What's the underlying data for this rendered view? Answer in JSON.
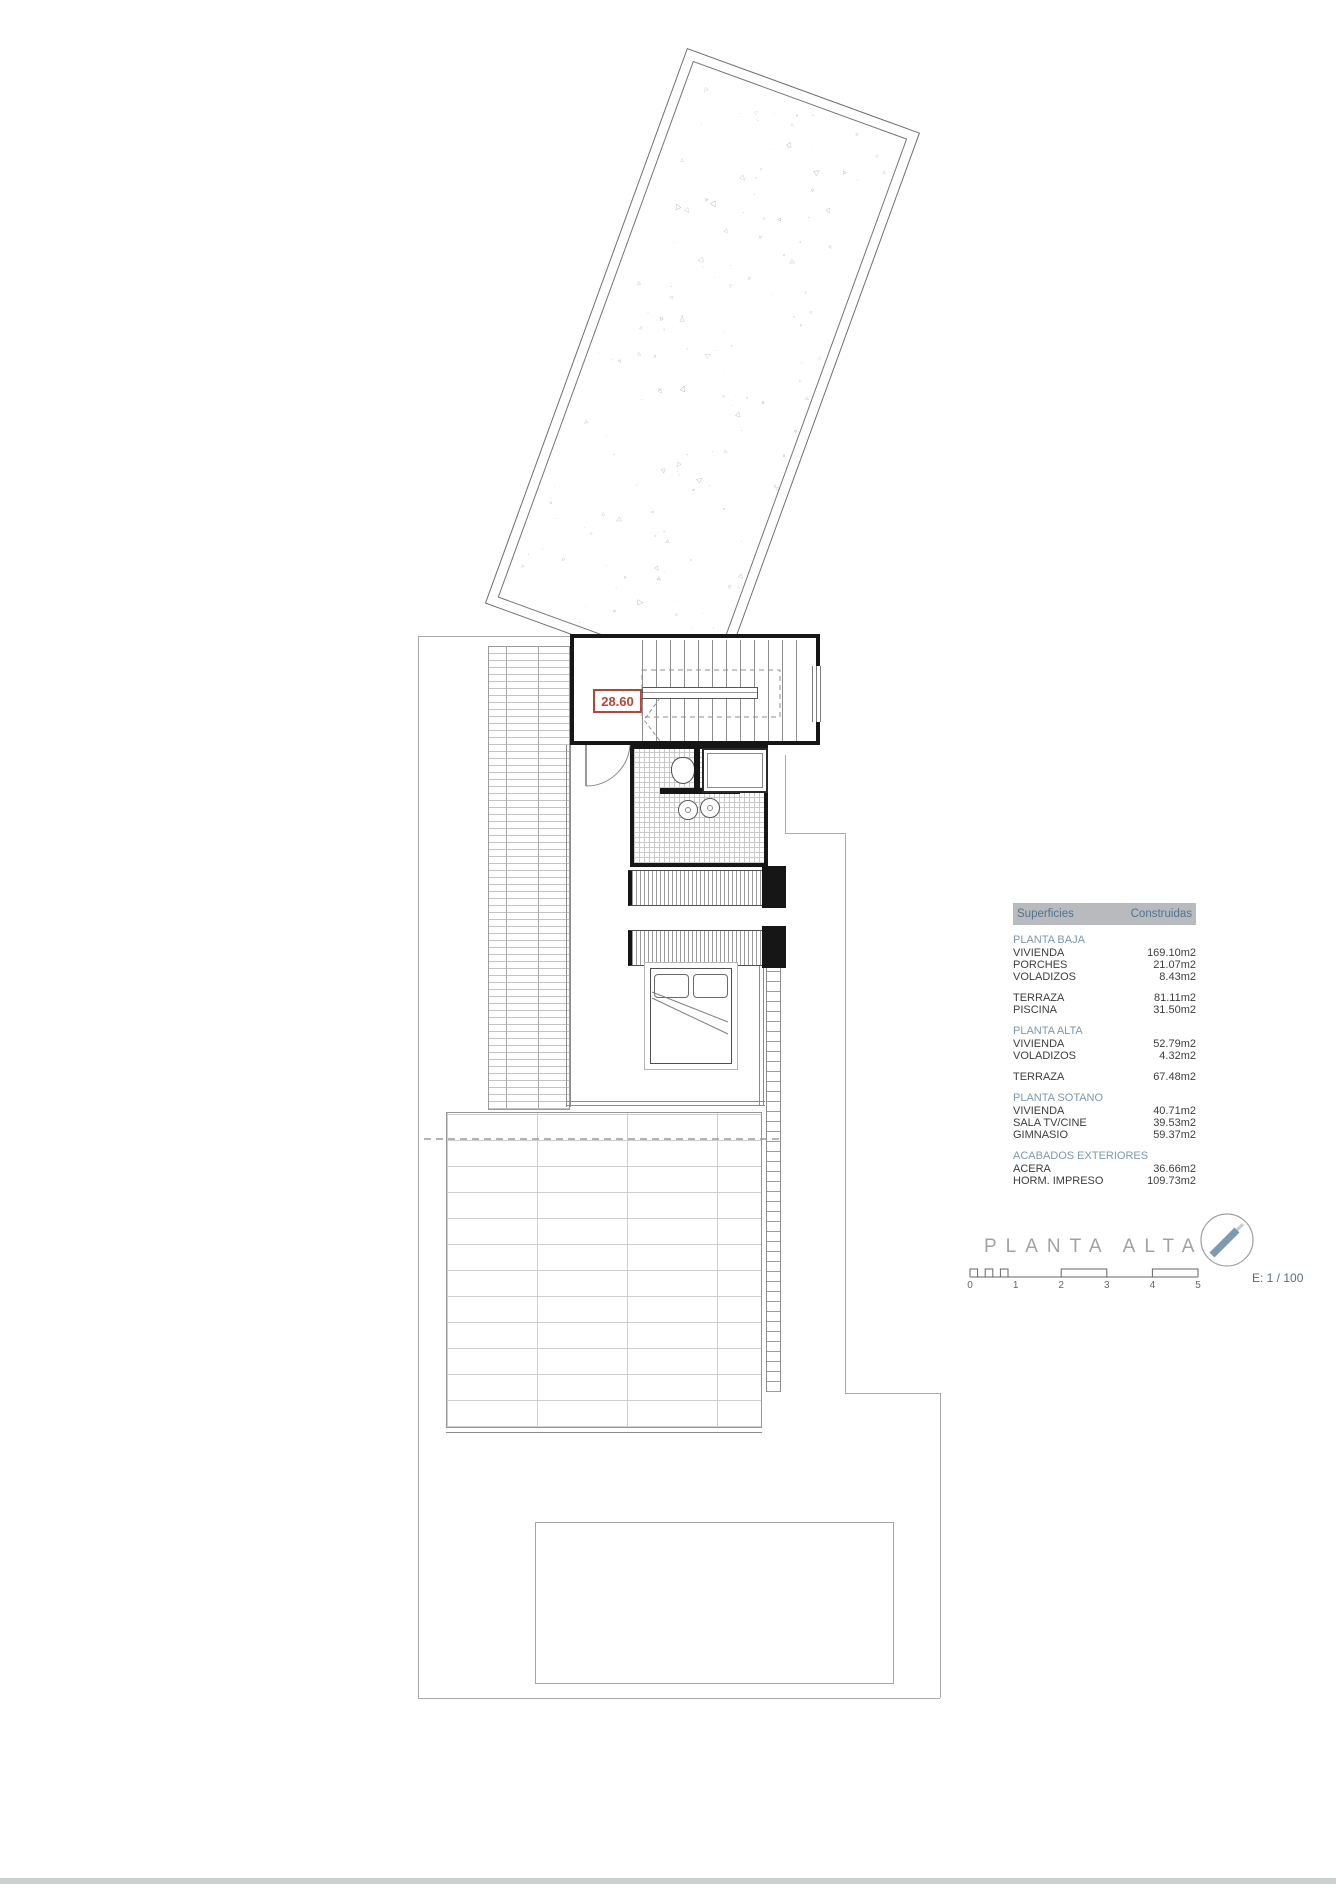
{
  "drawing": {
    "level_label": "28.60",
    "title": "PLANTA ALTA",
    "scale_label": "E: 1 / 100",
    "scale_numbers": [
      "0",
      "1",
      "2",
      "3",
      "4",
      "5"
    ]
  },
  "areas_table": {
    "header": {
      "col1": "Superficies",
      "col2": "Construidas"
    },
    "sections": [
      {
        "header": "PLANTA BAJA",
        "rows": [
          [
            "VIVIENDA",
            "169.10m2"
          ],
          [
            "PORCHES",
            "21.07m2"
          ],
          [
            "VOLADIZOS",
            "8.43m2"
          ]
        ]
      },
      {
        "header": "",
        "rows": [
          [
            "TERRAZA",
            "81.11m2"
          ],
          [
            "PISCINA",
            "31.50m2"
          ]
        ]
      },
      {
        "header": "PLANTA ALTA",
        "rows": [
          [
            "VIVIENDA",
            "52.79m2"
          ],
          [
            "VOLADIZOS",
            "4.32m2"
          ]
        ]
      },
      {
        "header": "",
        "rows": [
          [
            "TERRAZA",
            "67.48m2"
          ]
        ]
      },
      {
        "header": "PLANTA SOTANO",
        "rows": [
          [
            "VIVIENDA",
            "40.71m2"
          ],
          [
            "SALA TV/CINE",
            "39.53m2"
          ],
          [
            "GIMNASIO",
            "59.37m2"
          ]
        ]
      },
      {
        "header": "ACABADOS EXTERIORES",
        "rows": [
          [
            "ACERA",
            "36.66m2"
          ],
          [
            "HORM. IMPRESO",
            "109.73m2"
          ]
        ]
      }
    ]
  },
  "colors": {
    "accent_red": "#b4453a",
    "table_header_bg": "#b8babd",
    "table_header_text": "#4e7490",
    "section_text": "#7e98ac",
    "row_text": "#3d3d3d",
    "title_text": "#a2a2a2",
    "north_arrow": "#7e99b0",
    "wall_black": "#161616"
  }
}
